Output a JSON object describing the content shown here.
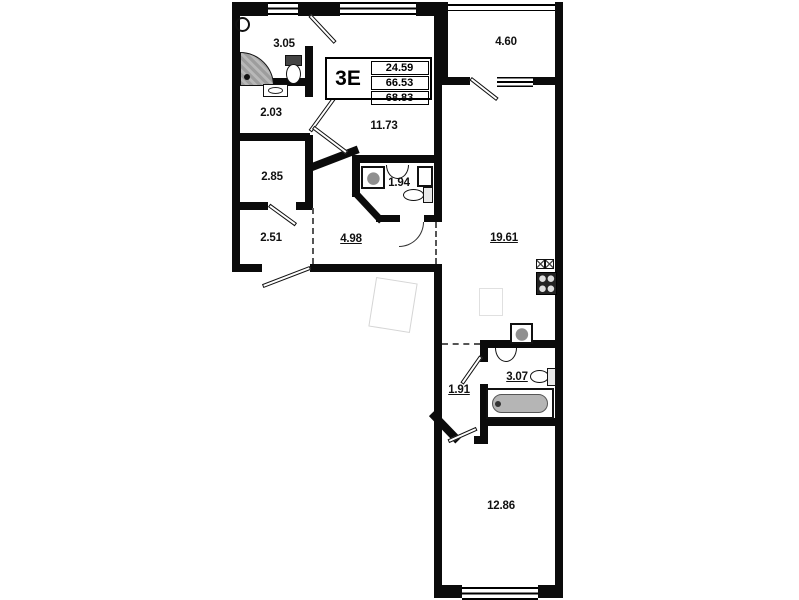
{
  "title_block": {
    "unit_type": "3Е",
    "living_area": "24.59",
    "apartment_area": "66.53",
    "total_area": "68.83"
  },
  "room_areas": {
    "shower_room": "3.05",
    "upper_hall": "2.03",
    "storage": "2.85",
    "entry_hall": "2.51",
    "corridor": "4.98",
    "bedroom_upper": "11.73",
    "wc": "1.94",
    "balcony": "4.60",
    "kitchen_living": "19.61",
    "bathroom": "3.07",
    "lower_hall": "1.91",
    "bedroom_lower": "12.86"
  },
  "colors": {
    "wall": "#0b0b0b",
    "fixture_shade": "#b5b5b5",
    "faint_outline": "#d5d5d5"
  }
}
